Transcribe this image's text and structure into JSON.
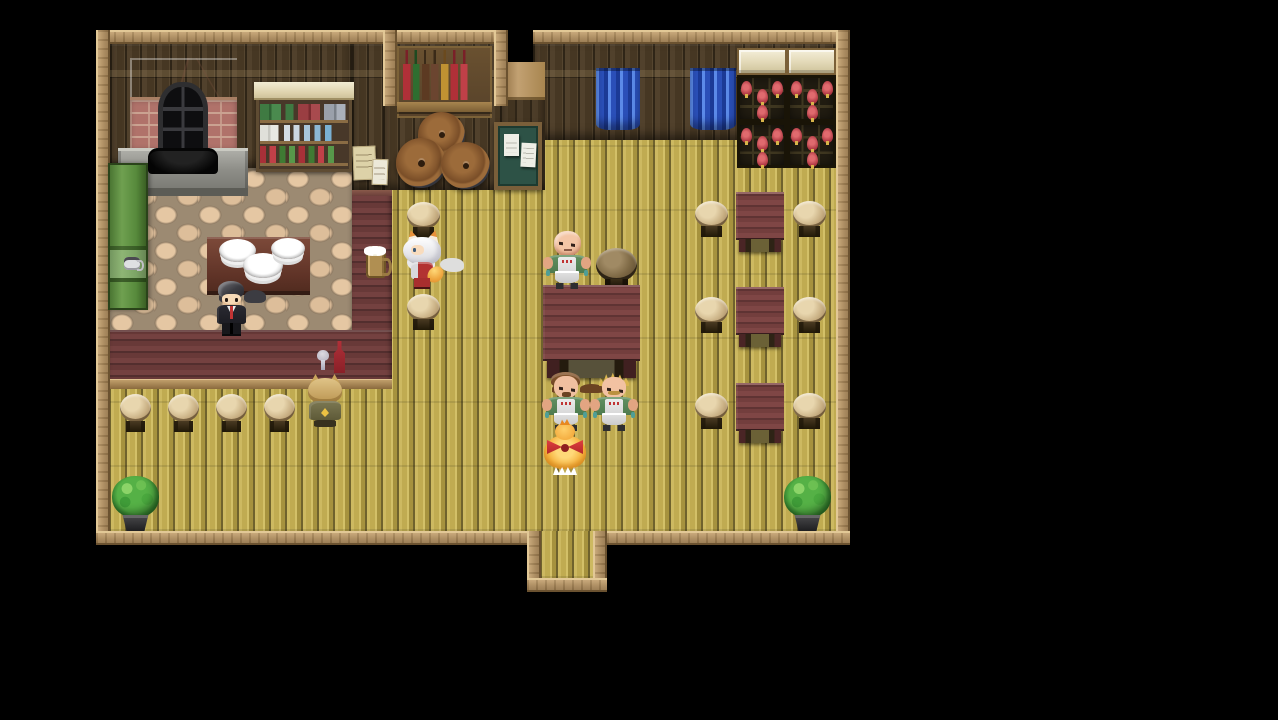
{
  "meta": {
    "app": "RPG Maker style game",
    "scene": "tavern interior map",
    "view": "top-down pixel-art, letterboxed on black"
  },
  "palette": {
    "background": "#000000",
    "frame_wood": "#a9885a",
    "wall_wood": "#4a3b28",
    "floor_planks": "#bfa94f",
    "kitchen_cobble": "#d9bb97",
    "counter_red": "#6b3a39",
    "table_red": "#733e3d",
    "stool_tan": "#c9b084",
    "curtain_blue": "#2a4fb8",
    "wine_bottle_red": "#b03a44",
    "plant_green": "#3f9c38",
    "apron_green": "#5a8a5a"
  },
  "scene": {
    "entities": [
      {
        "name": "tavern-floor",
        "kind": "floor",
        "x": 110,
        "y": 140,
        "w": 726,
        "h": 391,
        "interactable": true,
        "label": "main tavern plank floor"
      },
      {
        "name": "back-wall-right",
        "kind": "wall",
        "x": 533,
        "y": 44,
        "w": 303,
        "h": 96,
        "interactable": false,
        "label": "back wall"
      },
      {
        "name": "kitchen-wall",
        "kind": "wall",
        "x": 110,
        "y": 44,
        "w": 242,
        "h": 124,
        "interactable": false,
        "label": "kitchen back wall"
      },
      {
        "name": "divider-wall",
        "kind": "wall",
        "x": 352,
        "y": 44,
        "w": 46,
        "h": 146,
        "interactable": false,
        "label": "wall between kitchen and hall"
      },
      {
        "name": "alcove-wall",
        "kind": "wall",
        "x": 383,
        "y": 44,
        "w": 125,
        "h": 146,
        "interactable": false,
        "label": "alcove wall"
      },
      {
        "name": "pillar-wall",
        "kind": "pillar",
        "x": 500,
        "y": 62,
        "w": 45,
        "h": 128,
        "interactable": false,
        "label": "wall pillar"
      },
      {
        "name": "kitchen-floor",
        "kind": "cobble",
        "x": 110,
        "y": 168,
        "w": 242,
        "h": 177,
        "interactable": true,
        "label": "kitchen stone floor"
      },
      {
        "name": "frame-top-left",
        "kind": "frame-h",
        "x": 96,
        "y": 30,
        "w": 294,
        "h": 14,
        "interactable": false
      },
      {
        "name": "alcove-frame-top",
        "kind": "frame-h",
        "x": 383,
        "y": 30,
        "w": 125,
        "h": 14,
        "interactable": false
      },
      {
        "name": "alcove-frame-left",
        "kind": "frame-v",
        "x": 383,
        "y": 30,
        "w": 14,
        "h": 76,
        "interactable": false
      },
      {
        "name": "alcove-frame-right",
        "kind": "frame-v",
        "x": 494,
        "y": 30,
        "w": 14,
        "h": 76,
        "interactable": false
      },
      {
        "name": "frame-top-right",
        "kind": "frame-h",
        "x": 533,
        "y": 30,
        "w": 317,
        "h": 14,
        "interactable": false
      },
      {
        "name": "frame-left",
        "kind": "frame-v",
        "x": 96,
        "y": 30,
        "w": 14,
        "h": 515,
        "interactable": false
      },
      {
        "name": "frame-right",
        "kind": "frame-v",
        "x": 836,
        "y": 30,
        "w": 14,
        "h": 515,
        "interactable": false
      },
      {
        "name": "frame-bottom-left",
        "kind": "frame-h",
        "x": 96,
        "y": 531,
        "w": 431,
        "h": 14,
        "interactable": false
      },
      {
        "name": "frame-bottom-right",
        "kind": "frame-h",
        "x": 607,
        "y": 531,
        "w": 243,
        "h": 14,
        "interactable": false
      },
      {
        "name": "door-frame-left",
        "kind": "frame-v",
        "x": 527,
        "y": 531,
        "w": 14,
        "h": 61,
        "interactable": false
      },
      {
        "name": "door-frame-right",
        "kind": "frame-v",
        "x": 593,
        "y": 531,
        "w": 14,
        "h": 61,
        "interactable": false
      },
      {
        "name": "door-frame-bottom",
        "kind": "frame-h",
        "x": 527,
        "y": 578,
        "w": 80,
        "h": 14,
        "interactable": false
      },
      {
        "name": "exit-doorway",
        "kind": "floor",
        "x": 541,
        "y": 531,
        "w": 52,
        "h": 47,
        "interactable": true,
        "label": "south entrance doorway"
      },
      {
        "name": "fireplace",
        "kind": "fireplace",
        "x": 130,
        "y": 58,
        "w": 107,
        "h": 92,
        "interactable": false,
        "label": "brick fireplace oven"
      },
      {
        "name": "fireplace-base",
        "kind": "fpbase",
        "x": 118,
        "y": 148,
        "w": 130,
        "h": 48,
        "interactable": false,
        "label": "stone hearth"
      },
      {
        "name": "fireplace-opening",
        "kind": "fpopen",
        "x": 148,
        "y": 148,
        "w": 70,
        "h": 26,
        "interactable": false,
        "label": "firebox opening"
      },
      {
        "name": "dish-shelf",
        "kind": "mug-shelf",
        "x": 256,
        "y": 82,
        "w": 96,
        "h": 90,
        "interactable": false,
        "label": "shelf with mugs, jars, glasses and bottles"
      },
      {
        "name": "liquor-shelf",
        "kind": "bottle-shelf",
        "x": 397,
        "y": 46,
        "w": 95,
        "h": 72,
        "interactable": false,
        "label": "alcove shelf of liquor bottles"
      },
      {
        "name": "wall-papers",
        "kind": "wall-papers",
        "x": 353,
        "y": 146,
        "w": 38,
        "h": 44,
        "interactable": false,
        "label": "menu papers pinned to wall"
      },
      {
        "name": "notice-board",
        "kind": "notice-board",
        "x": 494,
        "y": 122,
        "w": 48,
        "h": 68,
        "interactable": true,
        "label": "green notice board with posted papers"
      },
      {
        "name": "barrel-stack",
        "kind": "barrels",
        "x": 396,
        "y": 112,
        "w": 96,
        "h": 78,
        "interactable": false,
        "label": "stack of three wooden barrels"
      },
      {
        "name": "curtain-left",
        "kind": "curtain",
        "x": 596,
        "y": 68,
        "w": 44,
        "h": 62,
        "interactable": false,
        "label": "blue window curtain"
      },
      {
        "name": "curtain-right",
        "kind": "curtain",
        "x": 690,
        "y": 68,
        "w": 46,
        "h": 62,
        "interactable": false,
        "label": "blue window curtain"
      },
      {
        "name": "cabinet-top-1",
        "kind": "cab",
        "x": 737,
        "y": 48,
        "w": 50,
        "h": 27,
        "interactable": false,
        "label": "cream cabinet top"
      },
      {
        "name": "cabinet-top-2",
        "kind": "cab",
        "x": 787,
        "y": 48,
        "w": 49,
        "h": 27,
        "interactable": false,
        "label": "cream cabinet top"
      },
      {
        "name": "wine-rack-1",
        "kind": "rack",
        "x": 737,
        "y": 75,
        "w": 50,
        "h": 47,
        "interactable": false,
        "label": "wine rack with red bottles"
      },
      {
        "name": "wine-rack-2",
        "kind": "rack",
        "x": 787,
        "y": 75,
        "w": 49,
        "h": 47,
        "interactable": false,
        "label": "wine rack with red bottles"
      },
      {
        "name": "wine-rack-3",
        "kind": "rack",
        "x": 737,
        "y": 122,
        "w": 50,
        "h": 46,
        "interactable": false,
        "label": "wine rack with red bottles"
      },
      {
        "name": "wine-rack-4",
        "kind": "rack",
        "x": 787,
        "y": 122,
        "w": 49,
        "h": 46,
        "interactable": false,
        "label": "wine rack with red bottles"
      },
      {
        "name": "green-cabinet",
        "kind": "green-cabinet",
        "x": 108,
        "y": 163,
        "w": 40,
        "h": 147,
        "interactable": false,
        "label": "green kitchen hutch"
      },
      {
        "name": "cup-on-cabinet",
        "kind": "cup",
        "x": 124,
        "y": 257,
        "w": 16,
        "h": 13,
        "interactable": false,
        "label": "cup on hutch ledge"
      },
      {
        "name": "kitchen-table",
        "kind": "plates-table",
        "x": 207,
        "y": 237,
        "w": 103,
        "h": 58,
        "interactable": false,
        "label": "table with stacked white plates"
      },
      {
        "name": "bar-counter-vertical",
        "kind": "counter-v",
        "x": 352,
        "y": 190,
        "w": 40,
        "h": 145,
        "interactable": false,
        "label": "bar counter (vertical run)"
      },
      {
        "name": "bar-counter-horizontal",
        "kind": "counter-h",
        "x": 110,
        "y": 330,
        "w": 282,
        "h": 59,
        "interactable": false,
        "label": "bar counter (horizontal run)"
      },
      {
        "name": "beer-mug",
        "kind": "beer-mug",
        "x": 366,
        "y": 251,
        "w": 20,
        "h": 27,
        "interactable": false,
        "label": "beer mug on counter"
      },
      {
        "name": "wine-bottle-and-glass",
        "kind": "wine-set",
        "x": 316,
        "y": 341,
        "w": 30,
        "h": 33,
        "interactable": false,
        "label": "wine bottle and glass on counter"
      },
      {
        "name": "bar-stool-1",
        "kind": "stool",
        "x": 120,
        "y": 394,
        "w": 31,
        "h": 38,
        "interactable": false,
        "label": "bar stool"
      },
      {
        "name": "bar-stool-2",
        "kind": "stool",
        "x": 168,
        "y": 394,
        "w": 31,
        "h": 38,
        "interactable": false,
        "label": "bar stool"
      },
      {
        "name": "bar-stool-3",
        "kind": "stool",
        "x": 216,
        "y": 394,
        "w": 31,
        "h": 38,
        "interactable": false,
        "label": "bar stool"
      },
      {
        "name": "bar-stool-4",
        "kind": "stool",
        "x": 264,
        "y": 394,
        "w": 31,
        "h": 38,
        "interactable": false,
        "label": "bar stool"
      },
      {
        "name": "stool-upper",
        "kind": "stool",
        "x": 407,
        "y": 202,
        "w": 33,
        "h": 36,
        "interactable": false,
        "label": "stool"
      },
      {
        "name": "stool-lower",
        "kind": "stool",
        "x": 407,
        "y": 294,
        "w": 33,
        "h": 36,
        "interactable": false,
        "label": "stool"
      },
      {
        "name": "small-round-table",
        "kind": "round-table",
        "x": 596,
        "y": 248,
        "w": 41,
        "h": 41,
        "interactable": false,
        "label": "small round table"
      },
      {
        "name": "center-table",
        "kind": "big-table",
        "x": 543,
        "y": 285,
        "w": 97,
        "h": 93,
        "interactable": false,
        "label": "large red dining table"
      },
      {
        "name": "dining-table-1",
        "kind": "sq-table",
        "x": 736,
        "y": 192,
        "w": 48,
        "h": 60,
        "interactable": false,
        "label": "red dining table"
      },
      {
        "name": "dining-table-2",
        "kind": "sq-table",
        "x": 736,
        "y": 287,
        "w": 48,
        "h": 60,
        "interactable": false,
        "label": "red dining table"
      },
      {
        "name": "dining-table-3",
        "kind": "sq-table",
        "x": 736,
        "y": 383,
        "w": 48,
        "h": 60,
        "interactable": false,
        "label": "red dining table"
      },
      {
        "name": "stool-t1-left",
        "kind": "stool",
        "x": 695,
        "y": 201,
        "w": 33,
        "h": 36,
        "interactable": false,
        "label": "stool"
      },
      {
        "name": "stool-t1-right",
        "kind": "stool",
        "x": 793,
        "y": 201,
        "w": 33,
        "h": 36,
        "interactable": false,
        "label": "stool"
      },
      {
        "name": "stool-t2-left",
        "kind": "stool",
        "x": 695,
        "y": 297,
        "w": 33,
        "h": 36,
        "interactable": false,
        "label": "stool"
      },
      {
        "name": "stool-t2-right",
        "kind": "stool",
        "x": 793,
        "y": 297,
        "w": 33,
        "h": 36,
        "interactable": false,
        "label": "stool"
      },
      {
        "name": "stool-t3-left",
        "kind": "stool",
        "x": 695,
        "y": 393,
        "w": 33,
        "h": 36,
        "interactable": false,
        "label": "stool"
      },
      {
        "name": "stool-t3-right",
        "kind": "stool",
        "x": 793,
        "y": 393,
        "w": 33,
        "h": 36,
        "interactable": false,
        "label": "stool"
      },
      {
        "name": "potted-plant-left",
        "kind": "plant",
        "x": 112,
        "y": 476,
        "w": 47,
        "h": 55,
        "interactable": false,
        "label": "potted bush"
      },
      {
        "name": "potted-plant-right",
        "kind": "plant",
        "x": 784,
        "y": 476,
        "w": 47,
        "h": 55,
        "interactable": false,
        "label": "potted bush"
      },
      {
        "name": "bartender",
        "kind": "char-bartender",
        "x": 215,
        "y": 281,
        "w": 33,
        "h": 53,
        "interactable": true,
        "label": "bartender in black suit with red tie"
      },
      {
        "name": "fox-eared-waitress",
        "kind": "char-fox",
        "x": 402,
        "y": 230,
        "w": 42,
        "h": 58,
        "interactable": true,
        "label": "white-haired fox-eared woman in red"
      },
      {
        "name": "bald-patron",
        "kind": "char-bald",
        "x": 545,
        "y": 230,
        "w": 45,
        "h": 59,
        "interactable": true,
        "label": "bald burly man in green apron"
      },
      {
        "name": "brown-haired-patron",
        "kind": "char-brown",
        "x": 544,
        "y": 372,
        "w": 44,
        "h": 57,
        "interactable": true,
        "label": "brown-haired burly man in green apron"
      },
      {
        "name": "blonde-patron",
        "kind": "char-blondpat",
        "x": 592,
        "y": 372,
        "w": 44,
        "h": 57,
        "interactable": true,
        "label": "blonde spiky-haired man with mustache in green apron"
      },
      {
        "name": "bird-companion",
        "kind": "char-bird",
        "x": 543,
        "y": 423,
        "w": 44,
        "h": 52,
        "interactable": true,
        "label": "orange bird creature with red ribbon bow"
      },
      {
        "name": "seated-bar-patron",
        "kind": "char-seated",
        "x": 305,
        "y": 374,
        "w": 40,
        "h": 54,
        "interactable": true,
        "label": "blonde cat-eared patron seated at the bar"
      }
    ]
  }
}
